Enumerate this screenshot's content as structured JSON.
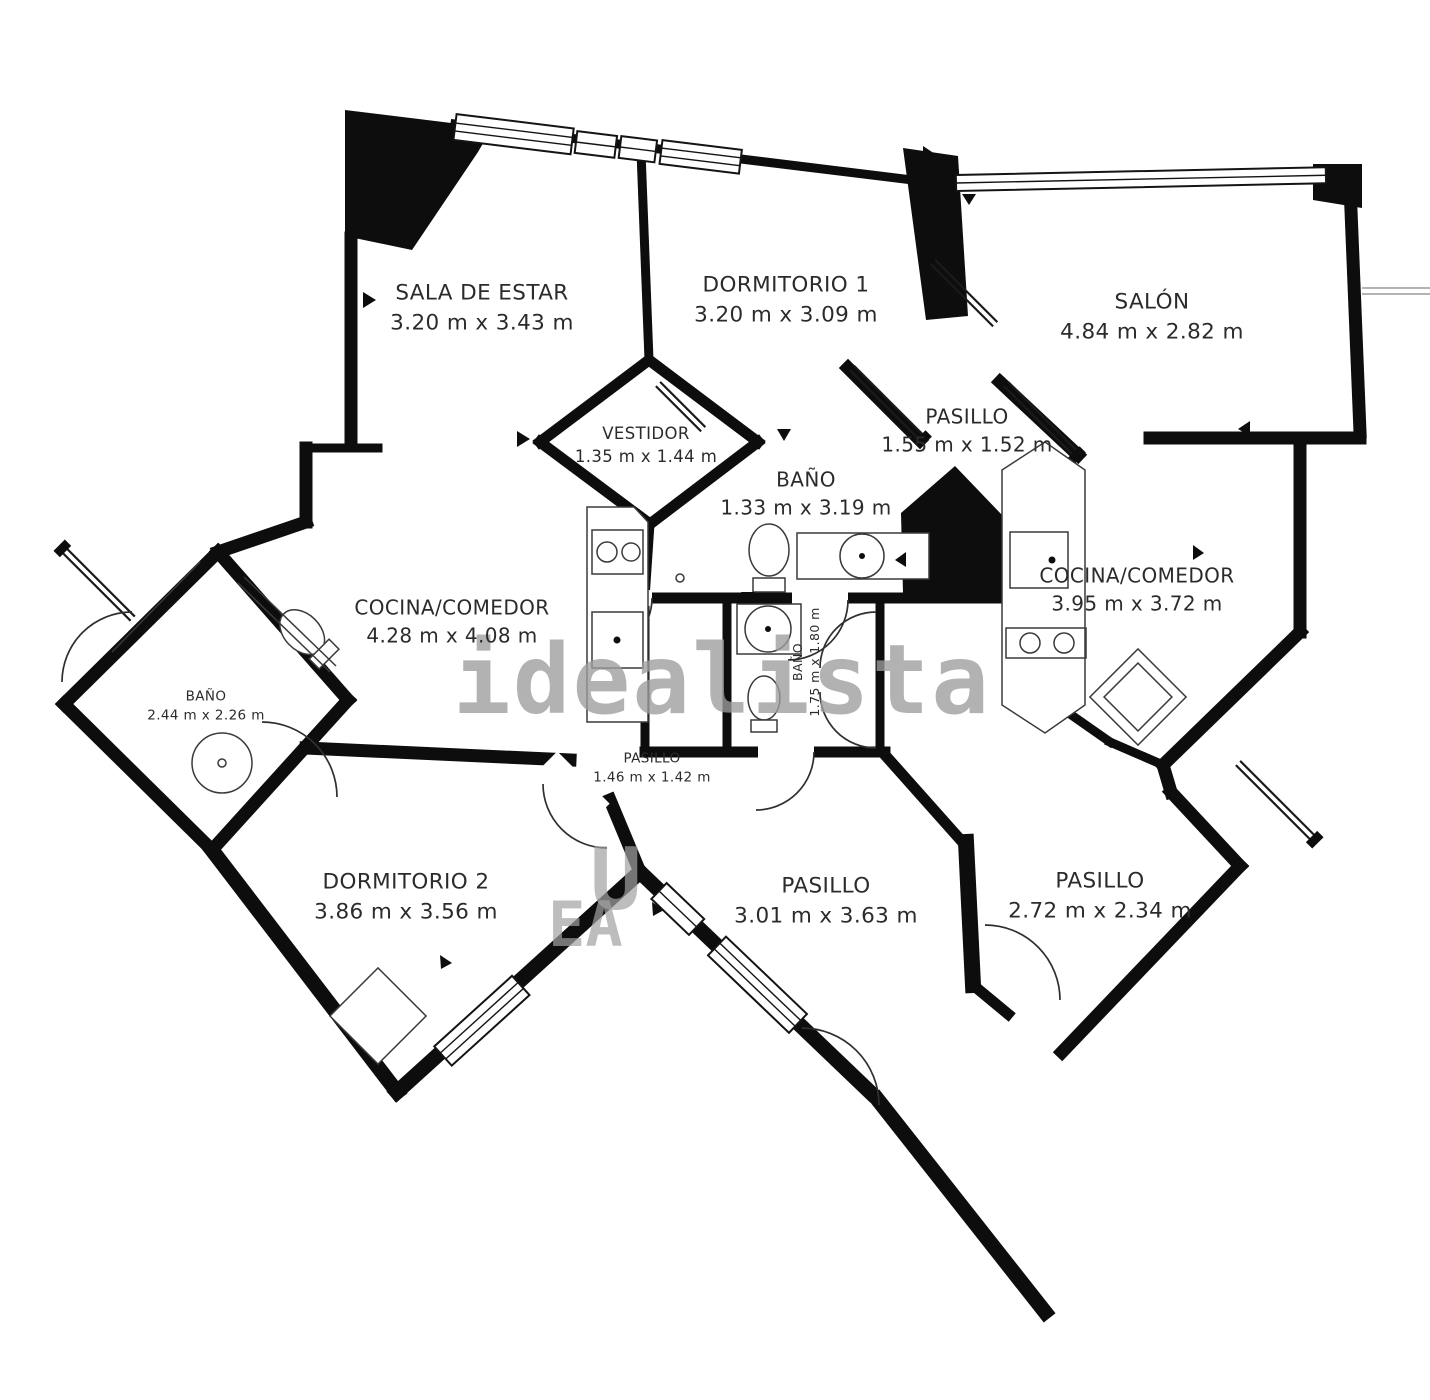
{
  "plan": {
    "watermark": "idealista",
    "watermark_fragments": [
      "U",
      "EA"
    ],
    "colors": {
      "wall": "#0d0d0d",
      "background": "#ffffff",
      "watermark": "#9d9d9d"
    },
    "rooms": [
      {
        "name": "SALA DE ESTAR",
        "dimensions": "3.20 m x 3.43 m"
      },
      {
        "name": "DORMITORIO 1",
        "dimensions": "3.20 m x 3.09 m"
      },
      {
        "name": "SALÓN",
        "dimensions": "4.84 m x 2.82 m"
      },
      {
        "name": "VESTIDOR",
        "dimensions": "1.35 m x 1.44 m"
      },
      {
        "name": "PASILLO",
        "dimensions": "1.55 m x 1.52 m"
      },
      {
        "name": "BAÑO",
        "dimensions": "1.33 m x 3.19 m"
      },
      {
        "name": "COCINA/COMEDOR",
        "dimensions": "4.28 m x 4.08 m"
      },
      {
        "name": "COCINA/COMEDOR",
        "dimensions": "3.95 m x 3.72 m"
      },
      {
        "name": "BAÑO",
        "dimensions": "2.44 m x 2.26 m"
      },
      {
        "name": "BAÑO",
        "dimensions": "1.75 m x 1.80 m"
      },
      {
        "name": "PASILLO",
        "dimensions": "1.46 m x 1.42 m"
      },
      {
        "name": "DORMITORIO  2",
        "dimensions": "3.86 m x 3.56 m"
      },
      {
        "name": "PASILLO",
        "dimensions": "3.01 m x 3.63 m"
      },
      {
        "name": "PASILLO",
        "dimensions": "2.72 m x 2.34 m"
      }
    ]
  }
}
